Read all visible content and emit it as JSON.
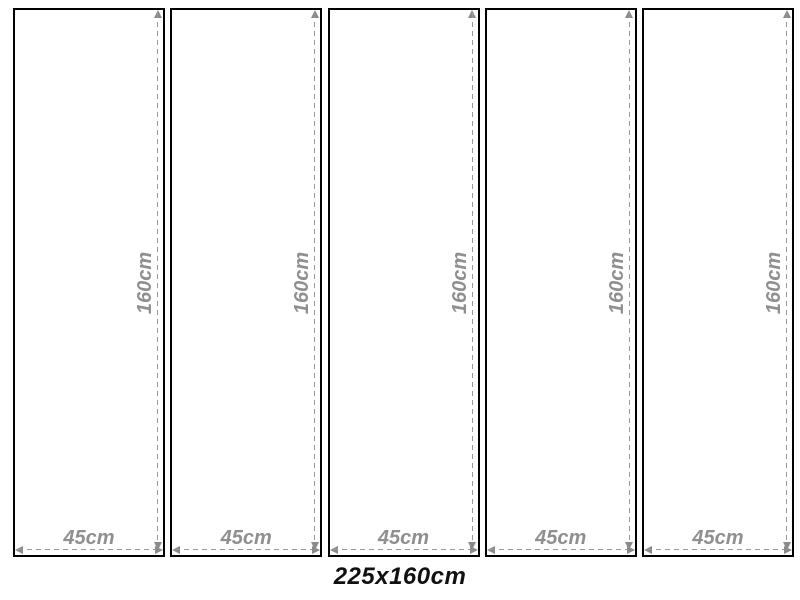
{
  "diagram": {
    "description_label": "multi-panel-size-diagram",
    "total_label": "225x160cm"
  },
  "panels": [
    {
      "height_label": "160cm",
      "width_label": "45cm"
    },
    {
      "height_label": "160cm",
      "width_label": "45cm"
    },
    {
      "height_label": "160cm",
      "width_label": "45cm"
    },
    {
      "height_label": "160cm",
      "width_label": "45cm"
    },
    {
      "height_label": "160cm",
      "width_label": "45cm"
    }
  ],
  "colors": {
    "background": "#ffffff",
    "panel_border": "#000000",
    "dimension_line": "#999999",
    "dimension_arrow": "#8a8a8a",
    "dimension_text": "#8f8f8f",
    "total_text": "#111111"
  }
}
